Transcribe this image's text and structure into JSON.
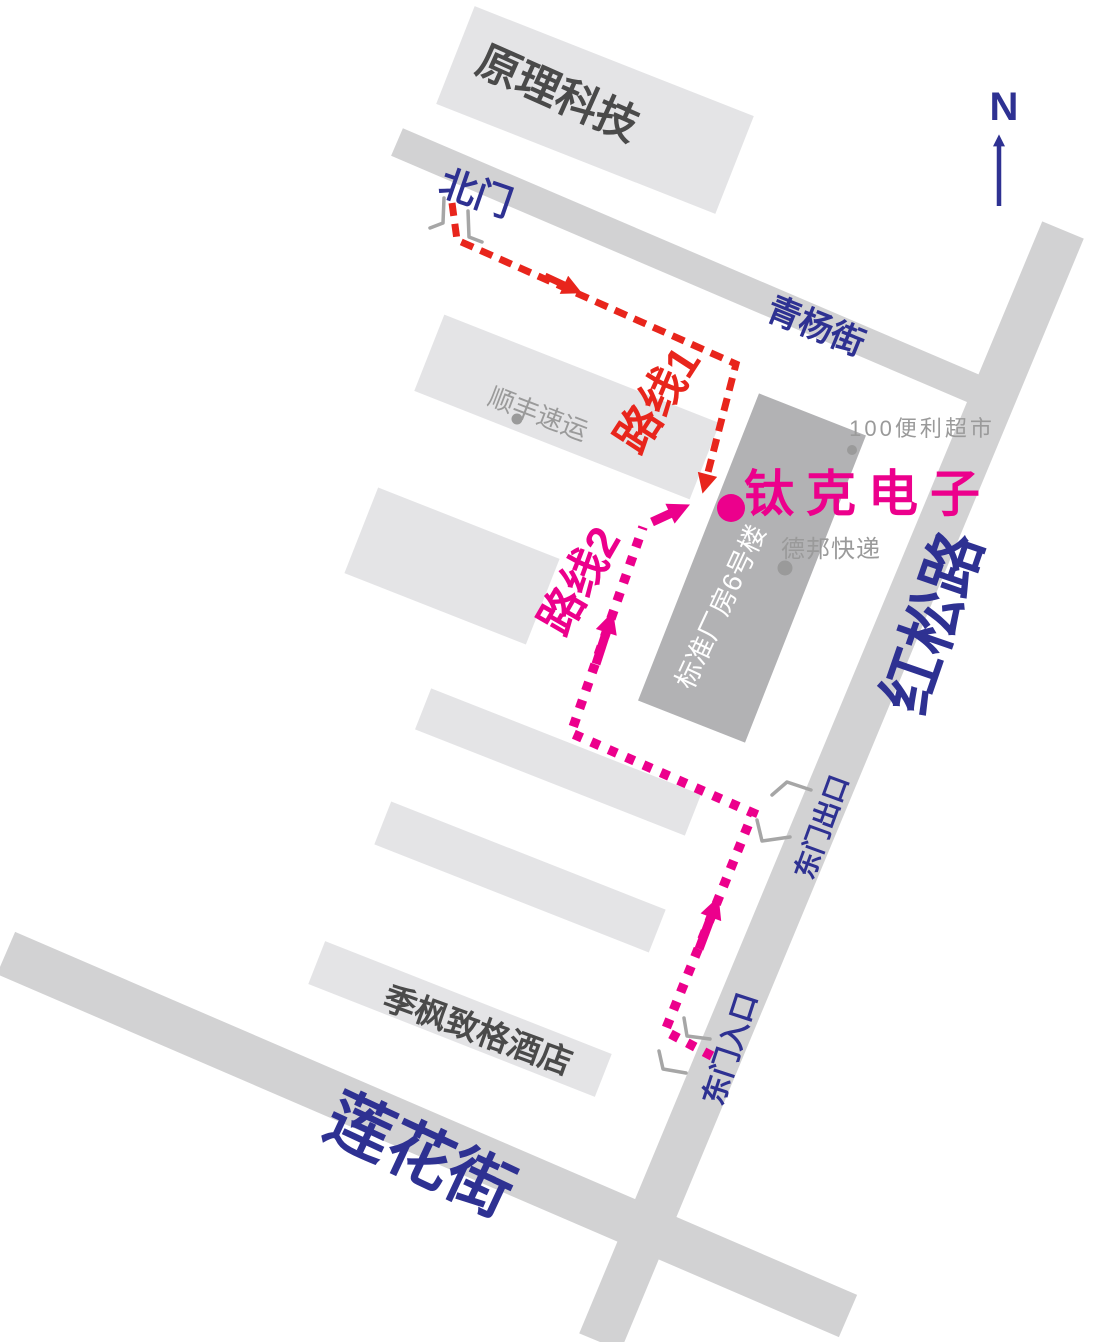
{
  "colors": {
    "road": "#d2d2d3",
    "building_light": "#e4e4e6",
    "building_dark": "#b2b2b4",
    "text_dark": "#4a4a4a",
    "text_gray": "#9a9a9a",
    "gate": "#a6a6a6",
    "blue": "#2e3192",
    "red": "#e8251c",
    "magenta": "#ec008c"
  },
  "compass": {
    "label": "N"
  },
  "streets": {
    "qingyang": "青杨街",
    "hongsong": "红松路",
    "lianhua": "莲花街"
  },
  "gates": {
    "north": "北门",
    "east_exit": "东门出口",
    "east_entrance": "东门入口"
  },
  "routes": {
    "route1_label": "路线1",
    "route2_label": "路线2"
  },
  "destination": {
    "label": "钛克电子"
  },
  "places": {
    "yuanli": "原理科技",
    "shunfeng": "顺丰速运",
    "convenience": "100便利超市",
    "debang": "德邦快递",
    "factory": "标准厂房6号楼",
    "hotel": "季枫致格酒店"
  }
}
